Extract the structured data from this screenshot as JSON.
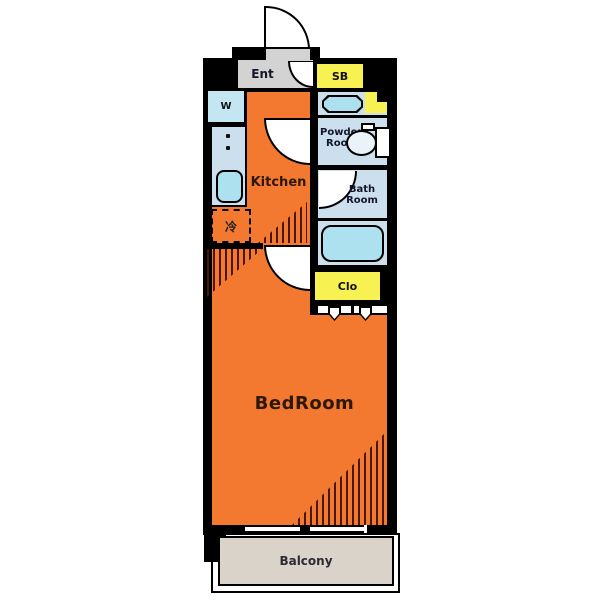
{
  "title": "1K apartment floor plan",
  "labels": {
    "entrance": "Ent",
    "shoe_box": "SB",
    "washer": "W",
    "kitchen": "Kitchen",
    "powder_line1": "Powder",
    "powder_line2": "Room",
    "bath_line1": "Bath",
    "bath_line2": "Room",
    "closet": "Clo",
    "bedroom": "BedRoom",
    "balcony": "Balcony",
    "refrigerator_symbol": "冷"
  },
  "colors": {
    "floor_orange": "#F2792F",
    "room_blue": "#CBDFEC",
    "fixture_cyan": "#AEE1EF",
    "storage_yellow": "#F7F152",
    "entrance_gray": "#D3D3D3",
    "balcony_beige": "#D9D3CA",
    "wall_black": "#000000",
    "hatch_brown": "#4A1605"
  }
}
